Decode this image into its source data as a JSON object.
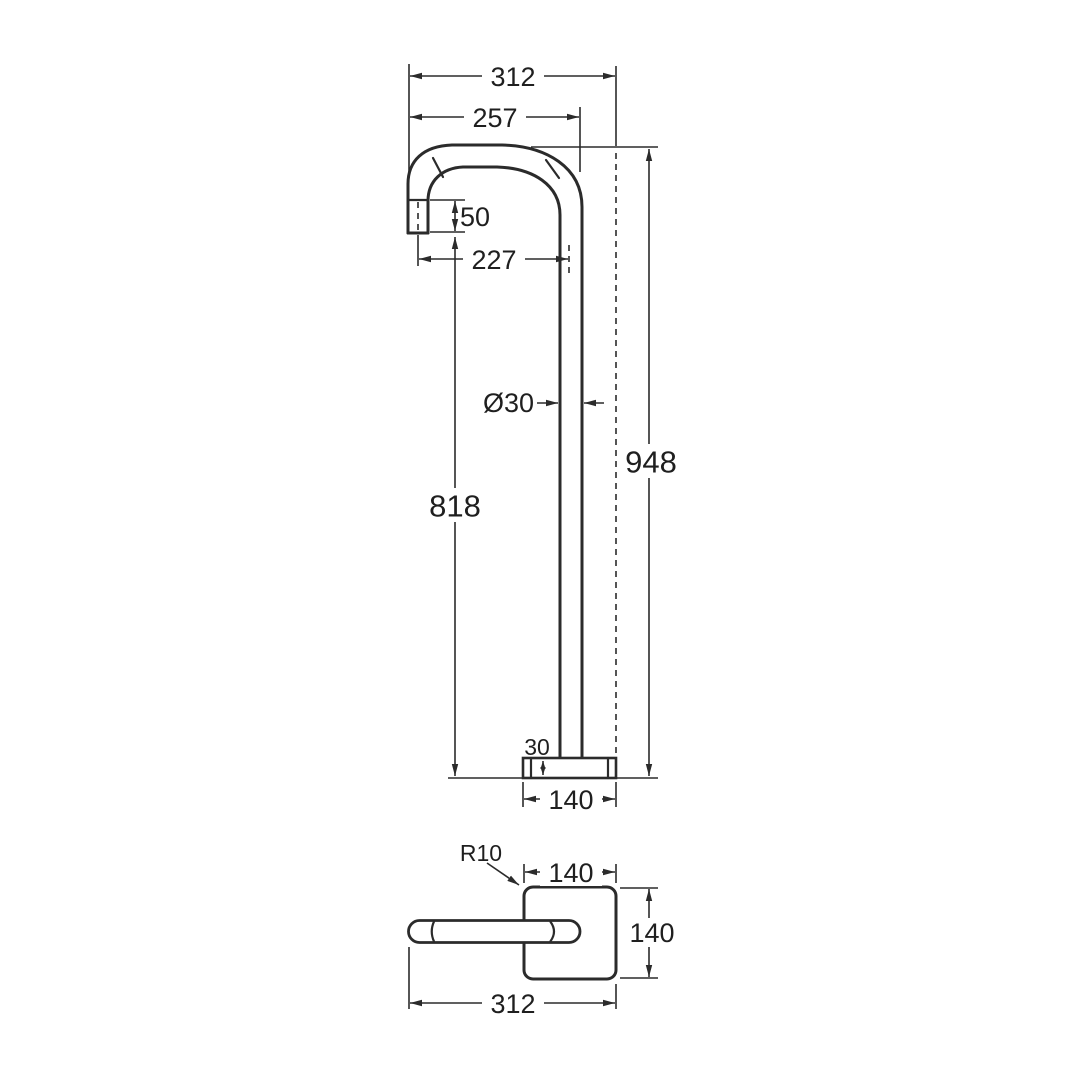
{
  "drawing": {
    "type": "technical-dimension-drawing",
    "subject": "freestanding-bath-spout",
    "units": "mm",
    "line_color": "#2b2b2b",
    "background_color": "#ffffff",
    "views": {
      "elevation": {
        "name": "front-elevation",
        "dims": {
          "overall_width": "312",
          "width_to_spout_outer": "257",
          "outlet_drop": "50",
          "outlet_to_pipe_centre": "227",
          "pipe_diameter": "Ø30",
          "outlet_height": "818",
          "overall_height": "948",
          "base_thickness": "30",
          "base_width": "140"
        }
      },
      "plan": {
        "name": "plan-view",
        "dims": {
          "corner_radius": "R10",
          "base_width": "140",
          "base_depth": "140",
          "overall_width": "312"
        }
      }
    }
  }
}
